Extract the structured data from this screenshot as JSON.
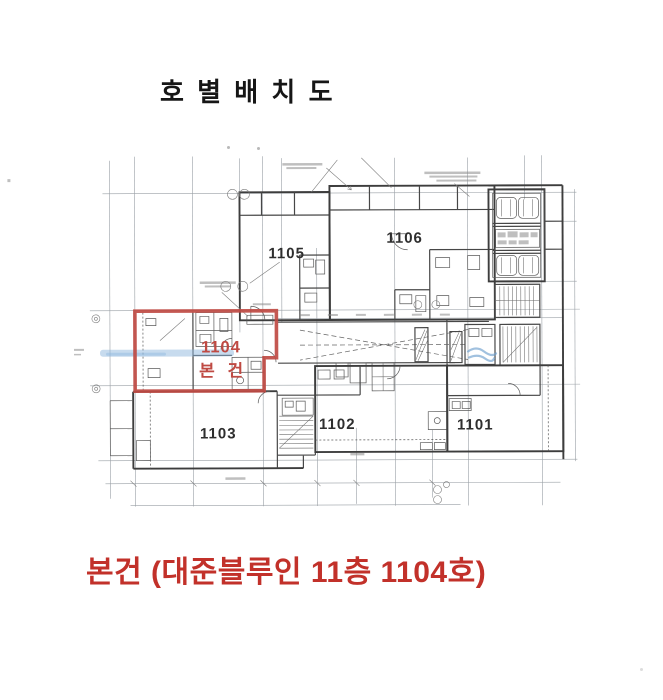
{
  "page": {
    "title": "호 별 배 치 도",
    "caption": "본건 (대준블루인 11층 1104호)"
  },
  "plan": {
    "units": [
      {
        "label": "1105"
      },
      {
        "label": "1106"
      },
      {
        "label": "1103"
      },
      {
        "label": "1102"
      },
      {
        "label": "1101"
      }
    ],
    "subject": {
      "number": "1104",
      "marker": "본 건"
    },
    "colors": {
      "highlight_outline_red": "#bf4a43",
      "caption_red": "#c2312a",
      "wall_ink": "#474747",
      "grid_line": "#9aa0a6",
      "highlighter_blue": "#8fb8dd"
    }
  }
}
